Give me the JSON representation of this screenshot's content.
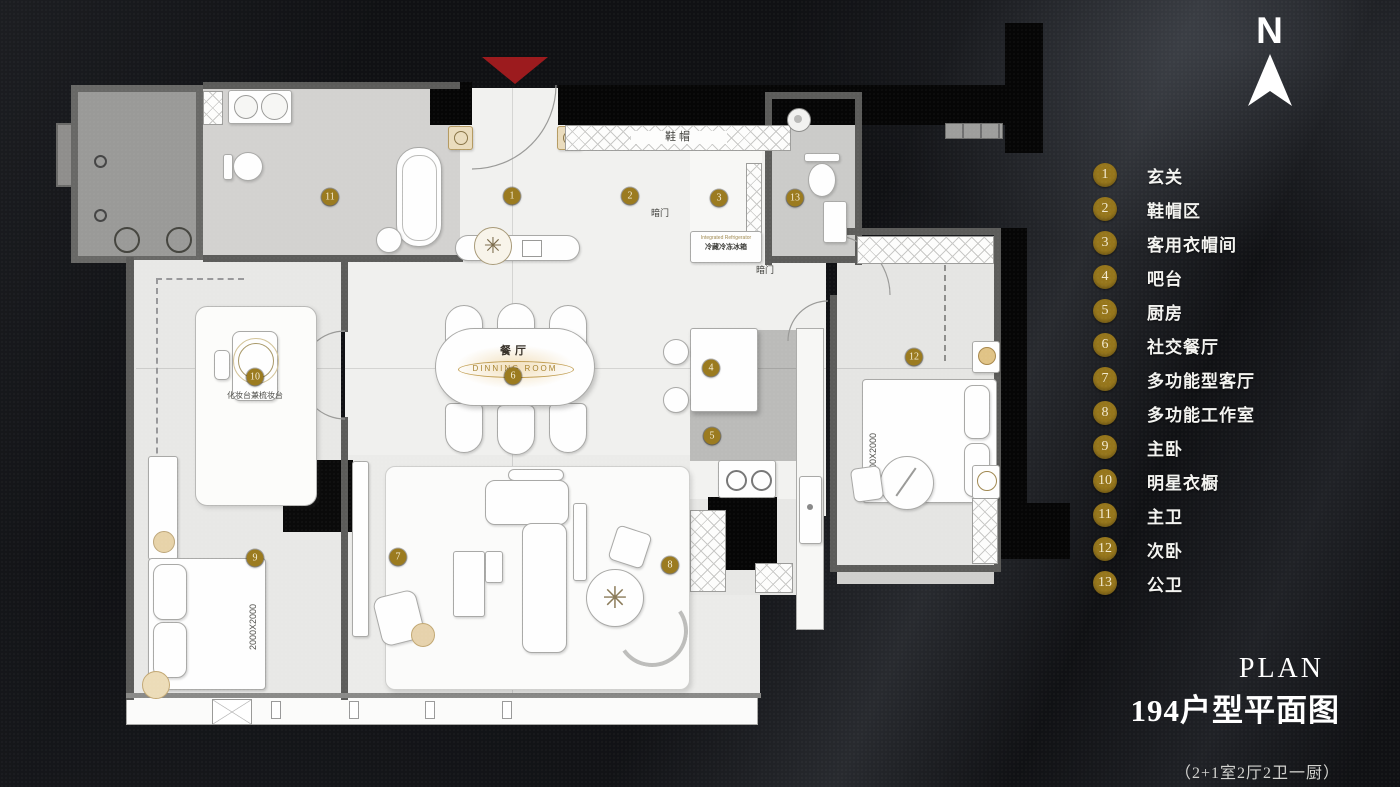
{
  "compass": {
    "label": "N"
  },
  "legend": {
    "badge_color": "#96761c",
    "items": [
      {
        "num": "1",
        "label": "玄关"
      },
      {
        "num": "2",
        "label": "鞋帽区"
      },
      {
        "num": "3",
        "label": "客用衣帽间"
      },
      {
        "num": "4",
        "label": "吧台"
      },
      {
        "num": "5",
        "label": "厨房"
      },
      {
        "num": "6",
        "label": "社交餐厅"
      },
      {
        "num": "7",
        "label": "多功能型客厅"
      },
      {
        "num": "8",
        "label": "多功能工作室"
      },
      {
        "num": "9",
        "label": "主卧"
      },
      {
        "num": "10",
        "label": "明星衣橱"
      },
      {
        "num": "11",
        "label": "主卫"
      },
      {
        "num": "12",
        "label": "次卧"
      },
      {
        "num": "13",
        "label": "公卫"
      }
    ]
  },
  "title": {
    "en": "PLAN",
    "zh": "194户型平面图",
    "sub": "（2+1室2厅2卫一厨）"
  },
  "plan": {
    "marker_color": "#9b7b20",
    "entry_color": "#9c1b1e",
    "labels": {
      "shoe_cabinet": "鞋帽",
      "hidden_door_a": "暗门",
      "hidden_door_b": "暗门",
      "fridge_en": "Integrated Refrigerator",
      "fridge_zh": "冷藏冷冻冰箱",
      "dining_zh": "餐厅",
      "dining_en": "DINNING ROOM",
      "dressing_table": "化妆台兼梳妆台",
      "bed_master_size": "2000X2000",
      "bed_second_size": "1500X2000"
    },
    "markers": [
      {
        "n": "1",
        "x": 456,
        "y": 139
      },
      {
        "n": "2",
        "x": 574,
        "y": 139
      },
      {
        "n": "3",
        "x": 663,
        "y": 141
      },
      {
        "n": "4",
        "x": 655,
        "y": 311
      },
      {
        "n": "5",
        "x": 656,
        "y": 379
      },
      {
        "n": "6",
        "x": 457,
        "y": 319
      },
      {
        "n": "7",
        "x": 342,
        "y": 500
      },
      {
        "n": "8",
        "x": 614,
        "y": 508
      },
      {
        "n": "9",
        "x": 199,
        "y": 501
      },
      {
        "n": "10",
        "x": 199,
        "y": 320
      },
      {
        "n": "11",
        "x": 274,
        "y": 140
      },
      {
        "n": "12",
        "x": 858,
        "y": 300
      },
      {
        "n": "13",
        "x": 739,
        "y": 141
      }
    ]
  }
}
